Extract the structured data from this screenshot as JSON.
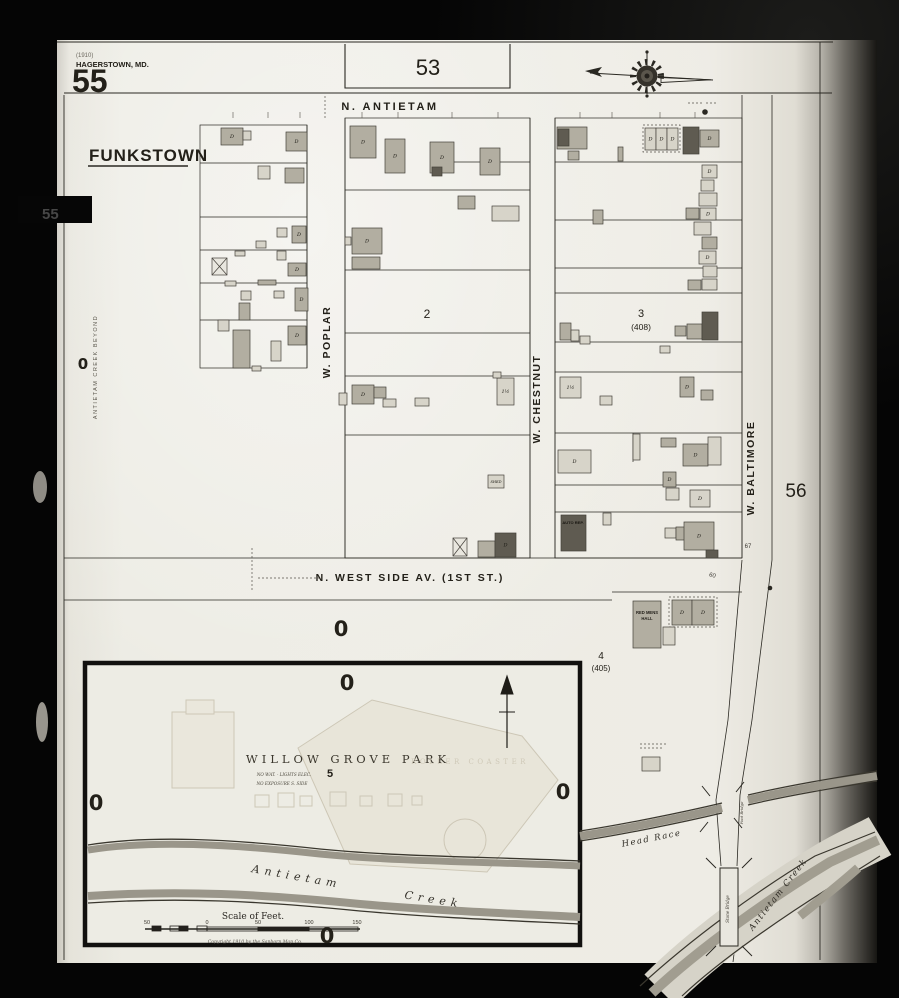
{
  "palette": {
    "paper": "#edebe3",
    "ink": "#2a2822",
    "light": "#d7d4c9",
    "mid": "#b2aea1",
    "dark": "#5f5b51",
    "cross_fill": "#e9e7df",
    "water": "#9a968a",
    "water_light": "#d6d3c8",
    "faint": "#cdc7b6"
  },
  "labels": [
    {
      "id": "date-note",
      "text": "(1910)",
      "x": 76,
      "y": 57,
      "s": 6,
      "anchor": "start",
      "col": "#6b675e"
    },
    {
      "id": "city-name",
      "text": "HAGERSTOWN, MD.",
      "x": 76,
      "y": 67,
      "s": 7.5,
      "anchor": "start",
      "cls": "sansb"
    },
    {
      "id": "sheet-number",
      "text": "55",
      "x": 72,
      "y": 92,
      "s": 32,
      "anchor": "start",
      "cls": "sansb"
    },
    {
      "id": "town-name",
      "text": "FUNKSTOWN",
      "x": 89,
      "y": 161,
      "s": 17,
      "anchor": "start",
      "cls": "sansb",
      "ls": 1
    },
    {
      "id": "adjacent-sheet-53",
      "text": "53",
      "x": 428,
      "y": 75,
      "s": 22
    },
    {
      "id": "street-n-antietam",
      "text": "N. ANTIETAM",
      "x": 390,
      "y": 110,
      "s": 11,
      "cls": "sansb",
      "ls": 2.5
    },
    {
      "id": "street-w-poplar",
      "text": "W. POPLAR",
      "x": 330,
      "y": 342,
      "s": 10.5,
      "cls": "sansb",
      "ls": 1.5,
      "rot": -90
    },
    {
      "id": "block-2-number",
      "text": "2",
      "x": 427,
      "y": 318,
      "s": 12
    },
    {
      "id": "street-w-chestnut",
      "text": "W. CHESTNUT",
      "x": 540,
      "y": 399,
      "s": 10.5,
      "cls": "sansb",
      "ls": 1.5,
      "rot": -90
    },
    {
      "id": "block-3-number",
      "text": "3",
      "x": 641,
      "y": 317,
      "s": 11
    },
    {
      "id": "block-3-alt",
      "text": "(408)",
      "x": 641,
      "y": 330,
      "s": 8.5
    },
    {
      "id": "street-w-baltimore",
      "text": "W. BALTIMORE",
      "x": 754,
      "y": 468,
      "s": 10.5,
      "cls": "sansb",
      "ls": 1.5,
      "rot": -90
    },
    {
      "id": "adjacent-sheet-56",
      "text": "56",
      "x": 796,
      "y": 497,
      "s": 19
    },
    {
      "id": "street-west-side",
      "text": "N. WEST SIDE  AV. (1ST ST.)",
      "x": 410,
      "y": 581,
      "s": 10.5,
      "cls": "sansb",
      "ls": 2
    },
    {
      "id": "block-4-number",
      "text": "4",
      "x": 601,
      "y": 659,
      "s": 10
    },
    {
      "id": "block-4-alt",
      "text": "(405)",
      "x": 601,
      "y": 671,
      "s": 8
    },
    {
      "id": "red-mens-hall-1",
      "text": "RED MENS",
      "x": 647,
      "y": 614,
      "s": 4.2,
      "cls": "sansb",
      "col": "#24211b"
    },
    {
      "id": "red-mens-hall-2",
      "text": "HALL",
      "x": 647,
      "y": 620,
      "s": 4.2,
      "cls": "sansb",
      "col": "#24211b"
    },
    {
      "id": "auto-repair",
      "text": "AUTO REP.",
      "x": 573,
      "y": 524,
      "s": 4,
      "cls": "sansb",
      "col": "#16140f"
    },
    {
      "id": "park-title",
      "text": "WILLOW GROVE PARK",
      "x": 348,
      "y": 763,
      "s": 11.5,
      "cls": "serif",
      "ls": 4,
      "col": "#3b372d"
    },
    {
      "id": "block-5-number",
      "text": "5",
      "x": 330,
      "y": 777,
      "s": 11,
      "cls": "sansb"
    },
    {
      "id": "park-note-1",
      "text": "NO WAT. - LIGHTS ELEC.",
      "x": 284,
      "y": 776,
      "s": 4.2,
      "cls": "serifi",
      "col": "#4c483d"
    },
    {
      "id": "park-note-2",
      "text": "NO EXPOSURE S. SIDE",
      "x": 282,
      "y": 785,
      "s": 4.2,
      "cls": "serifi",
      "col": "#4c483d"
    },
    {
      "id": "park-roller-coaster",
      "text": "ROLLER COASTER",
      "x": 470,
      "y": 764,
      "s": 7,
      "cls": "serif",
      "ls": 3.5,
      "col": "#cfc9b8"
    },
    {
      "id": "creek-word-antietam",
      "text": "Antietam",
      "x": 296,
      "y": 880,
      "s": 11,
      "cls": "serifi",
      "ls": 5,
      "rot": 10,
      "col": "#34312a"
    },
    {
      "id": "creek-word-creek",
      "text": "Creek",
      "x": 433,
      "y": 903,
      "s": 11,
      "cls": "serifi",
      "ls": 5,
      "rot": 9,
      "col": "#34312a"
    },
    {
      "id": "head-race-label",
      "text": "Head Race",
      "x": 652,
      "y": 841,
      "s": 8.5,
      "cls": "serifi",
      "ls": 1.5,
      "rot": -11,
      "col": "#2f2c25"
    },
    {
      "id": "antietam-creek-lower",
      "text": "Antietam Creek",
      "x": 780,
      "y": 896,
      "s": 8.5,
      "cls": "serifi",
      "ls": 1.5,
      "rot": -52,
      "col": "#2f2c25"
    },
    {
      "id": "stone-bridge-label",
      "text": "Stone Bridge",
      "x": 729,
      "y": 909,
      "s": 4.2,
      "cls": "serifi",
      "rot": -90,
      "col": "#3e3a31"
    },
    {
      "id": "foot-bridge-label",
      "text": "Foot Bridge",
      "x": 743,
      "y": 813,
      "s": 3.8,
      "cls": "serifi",
      "rot": -90,
      "col": "#3e3a31"
    },
    {
      "id": "margin-note",
      "text": "ANTIETAM CREEK BEYOND",
      "x": 97,
      "y": 367,
      "s": 5.5,
      "ls": 1.5,
      "rot": -90,
      "col": "#5a564c"
    },
    {
      "id": "left-tab-number",
      "text": "55",
      "x": 42,
      "y": 219,
      "s": 15,
      "cls": "sansb",
      "col": "#474747",
      "anchor": "start"
    },
    {
      "id": "scale-title",
      "text": "Scale of Feet.",
      "x": 253,
      "y": 919,
      "s": 9,
      "cls": "serif",
      "col": "#2a2722"
    },
    {
      "id": "scale-tick-50l",
      "text": "50",
      "x": 147,
      "y": 924,
      "s": 5.5,
      "col": "#3a362e"
    },
    {
      "id": "scale-tick-0",
      "text": "0",
      "x": 207,
      "y": 924,
      "s": 5.5,
      "col": "#3a362e"
    },
    {
      "id": "scale-tick-50r",
      "text": "50",
      "x": 258,
      "y": 924,
      "s": 5.5,
      "col": "#3a362e"
    },
    {
      "id": "scale-tick-100",
      "text": "100",
      "x": 309,
      "y": 924,
      "s": 5.5,
      "col": "#3a362e"
    },
    {
      "id": "scale-tick-150",
      "text": "150",
      "x": 357,
      "y": 924,
      "s": 5.5,
      "col": "#3a362e"
    },
    {
      "id": "copyright-note",
      "text": "Copyright 1910 by the Sanborn Map Co.",
      "x": 255,
      "y": 943,
      "s": 4.6,
      "cls": "serifi",
      "col": "#56524a"
    },
    {
      "id": "house-number-67",
      "text": "67",
      "x": 748,
      "y": 548,
      "s": 6,
      "col": "#3b3832"
    },
    {
      "id": "house-number-60",
      "text": "60",
      "x": 712,
      "y": 577,
      "s": 6,
      "rot": 15,
      "col": "#3b3832"
    },
    {
      "id": "zero-marker-margin",
      "text": "0",
      "x": 83,
      "y": 369,
      "s": 15,
      "cls": "zero"
    },
    {
      "id": "zero-marker-1",
      "text": "0",
      "x": 341,
      "y": 636,
      "s": 21,
      "cls": "zero"
    },
    {
      "id": "zero-marker-2",
      "text": "0",
      "x": 347,
      "y": 690,
      "s": 21,
      "cls": "zero"
    },
    {
      "id": "zero-marker-3",
      "text": "0",
      "x": 96,
      "y": 810,
      "s": 21,
      "cls": "zero"
    },
    {
      "id": "zero-marker-4",
      "text": "0",
      "x": 563,
      "y": 799,
      "s": 21,
      "cls": "zero"
    },
    {
      "id": "zero-marker-5",
      "text": "0",
      "x": 327,
      "y": 943,
      "s": 21,
      "cls": "zero"
    }
  ],
  "buildings": [
    [
      221,
      128,
      22,
      17,
      "M",
      "D",
      0
    ],
    [
      243,
      131,
      8,
      9,
      "L",
      null,
      0
    ],
    [
      286,
      132,
      21,
      19,
      "M",
      "D",
      0
    ],
    [
      258,
      166,
      12,
      13,
      "L",
      null,
      0
    ],
    [
      285,
      168,
      19,
      15,
      "M",
      null,
      0
    ],
    [
      277,
      228,
      10,
      9,
      "L",
      null,
      0
    ],
    [
      292,
      226,
      14,
      17,
      "M",
      "D",
      0
    ],
    [
      256,
      241,
      10,
      7,
      "L",
      null,
      0
    ],
    [
      235,
      251,
      10,
      5,
      "L",
      null,
      0
    ],
    [
      212,
      258,
      15,
      17,
      "X",
      null,
      1
    ],
    [
      277,
      251,
      9,
      9,
      "L",
      null,
      0
    ],
    [
      288,
      263,
      18,
      13,
      "M",
      "D",
      0
    ],
    [
      225,
      281,
      11,
      5,
      "L",
      null,
      0
    ],
    [
      258,
      280,
      18,
      5,
      "M",
      null,
      0
    ],
    [
      241,
      291,
      10,
      9,
      "L",
      null,
      0
    ],
    [
      274,
      291,
      10,
      7,
      "L",
      null,
      0
    ],
    [
      295,
      288,
      13,
      23,
      "M",
      "D",
      0
    ],
    [
      239,
      303,
      11,
      17,
      "M",
      null,
      0
    ],
    [
      218,
      320,
      11,
      11,
      "L",
      null,
      0
    ],
    [
      233,
      330,
      17,
      38,
      "M",
      null,
      0
    ],
    [
      271,
      341,
      10,
      20,
      "L",
      null,
      0
    ],
    [
      288,
      326,
      18,
      19,
      "M",
      "D",
      0
    ],
    [
      252,
      366,
      9,
      5,
      "L",
      null,
      0
    ],
    [
      350,
      126,
      26,
      32,
      "M",
      "D",
      0
    ],
    [
      385,
      139,
      20,
      34,
      "M",
      "D",
      0
    ],
    [
      430,
      142,
      24,
      31,
      "M",
      "D",
      0
    ],
    [
      432,
      167,
      10,
      9,
      "D",
      null,
      0
    ],
    [
      458,
      196,
      17,
      13,
      "M",
      null,
      0
    ],
    [
      480,
      148,
      20,
      27,
      "M",
      "D",
      0
    ],
    [
      492,
      206,
      27,
      15,
      "L",
      null,
      0
    ],
    [
      352,
      228,
      30,
      26,
      "M",
      "D",
      0
    ],
    [
      345,
      237,
      6,
      8,
      "L",
      null,
      0
    ],
    [
      352,
      257,
      28,
      12,
      "M",
      null,
      0
    ],
    [
      352,
      385,
      22,
      19,
      "M",
      "D",
      0
    ],
    [
      374,
      387,
      12,
      11,
      "M",
      null,
      0
    ],
    [
      339,
      393,
      8,
      12,
      "L",
      null,
      0
    ],
    [
      383,
      399,
      13,
      8,
      "L",
      null,
      0
    ],
    [
      415,
      398,
      14,
      8,
      "L",
      null,
      0
    ],
    [
      497,
      378,
      17,
      27,
      "L",
      "1½",
      0
    ],
    [
      493,
      372,
      8,
      6,
      "L",
      null,
      0
    ],
    [
      488,
      475,
      16,
      13,
      "L",
      "SHED",
      0
    ],
    [
      453,
      538,
      14,
      18,
      "X",
      null,
      1
    ],
    [
      478,
      541,
      17,
      16,
      "M",
      null,
      0
    ],
    [
      495,
      533,
      21,
      24,
      "D",
      "D",
      0
    ],
    [
      557,
      127,
      30,
      22,
      "M",
      null,
      0
    ],
    [
      558,
      129,
      11,
      17,
      "D",
      null,
      0
    ],
    [
      568,
      151,
      11,
      9,
      "M",
      null,
      0
    ],
    [
      593,
      210,
      10,
      14,
      "M",
      null,
      0
    ],
    [
      618,
      147,
      5,
      14,
      "M",
      null,
      0
    ],
    [
      645,
      128,
      11,
      22,
      "L",
      "D",
      0
    ],
    [
      656,
      128,
      11,
      22,
      "L",
      "D",
      0
    ],
    [
      667,
      128,
      11,
      22,
      "L",
      "D",
      0
    ],
    [
      683,
      127,
      16,
      27,
      "D",
      null,
      0
    ],
    [
      700,
      130,
      19,
      17,
      "M",
      "D",
      0
    ],
    [
      702,
      165,
      15,
      13,
      "L",
      "D",
      0
    ],
    [
      701,
      180,
      13,
      11,
      "L",
      null,
      0
    ],
    [
      699,
      193,
      18,
      13,
      "L",
      null,
      0
    ],
    [
      686,
      208,
      13,
      11,
      "M",
      null,
      0
    ],
    [
      700,
      208,
      16,
      12,
      "L",
      "D",
      0
    ],
    [
      694,
      222,
      17,
      13,
      "L",
      null,
      0
    ],
    [
      702,
      237,
      15,
      12,
      "M",
      null,
      0
    ],
    [
      699,
      251,
      17,
      13,
      "L",
      "D",
      0
    ],
    [
      703,
      266,
      14,
      11,
      "L",
      null,
      0
    ],
    [
      688,
      280,
      13,
      10,
      "M",
      null,
      0
    ],
    [
      702,
      279,
      15,
      11,
      "L",
      null,
      0
    ],
    [
      560,
      323,
      11,
      17,
      "M",
      null,
      0
    ],
    [
      571,
      330,
      8,
      11,
      "L",
      null,
      0
    ],
    [
      580,
      336,
      10,
      8,
      "L",
      null,
      0
    ],
    [
      675,
      326,
      11,
      10,
      "M",
      null,
      0
    ],
    [
      687,
      324,
      15,
      15,
      "M",
      null,
      0
    ],
    [
      702,
      312,
      16,
      28,
      "D",
      null,
      0
    ],
    [
      660,
      346,
      10,
      7,
      "L",
      null,
      0
    ],
    [
      560,
      377,
      21,
      21,
      "L",
      "1½",
      0
    ],
    [
      600,
      396,
      12,
      9,
      "L",
      null,
      0
    ],
    [
      680,
      377,
      14,
      20,
      "M",
      "D",
      0
    ],
    [
      701,
      390,
      12,
      10,
      "M",
      null,
      0
    ],
    [
      558,
      450,
      33,
      23,
      "L",
      "D",
      0
    ],
    [
      633,
      434,
      7,
      26,
      "L",
      null,
      0
    ],
    [
      661,
      438,
      15,
      9,
      "M",
      null,
      0
    ],
    [
      683,
      444,
      25,
      22,
      "M",
      "D",
      0
    ],
    [
      708,
      437,
      13,
      28,
      "L",
      null,
      0
    ],
    [
      663,
      472,
      13,
      15,
      "M",
      "D",
      0
    ],
    [
      666,
      488,
      13,
      12,
      "L",
      null,
      0
    ],
    [
      690,
      490,
      20,
      17,
      "L",
      "D",
      0
    ],
    [
      603,
      513,
      8,
      12,
      "L",
      null,
      0
    ],
    [
      561,
      515,
      25,
      36,
      "D",
      null,
      0
    ],
    [
      665,
      528,
      11,
      10,
      "L",
      null,
      0
    ],
    [
      676,
      527,
      10,
      13,
      "M",
      null,
      0
    ],
    [
      684,
      522,
      30,
      28,
      "M",
      "D",
      0
    ],
    [
      706,
      550,
      12,
      8,
      "D",
      null,
      0
    ],
    [
      633,
      601,
      28,
      47,
      "M",
      null,
      0
    ],
    [
      663,
      627,
      12,
      18,
      "L",
      null,
      0
    ],
    [
      672,
      600,
      20,
      25,
      "M",
      "D",
      0
    ],
    [
      692,
      600,
      22,
      25,
      "M",
      "D",
      0
    ],
    [
      642,
      757,
      18,
      14,
      "L",
      null,
      0
    ]
  ]
}
